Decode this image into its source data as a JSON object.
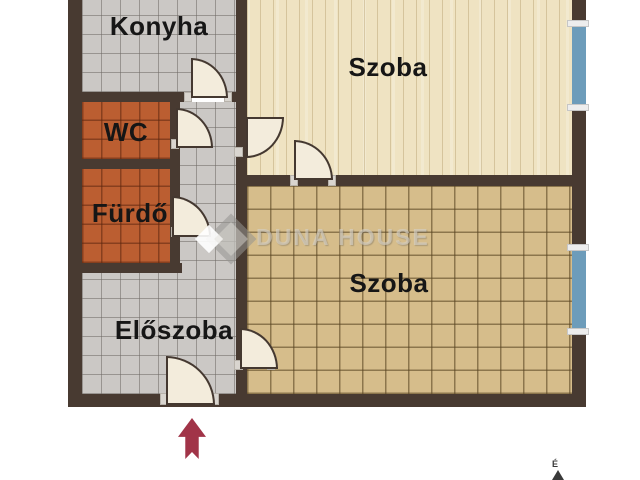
{
  "plan": {
    "rooms": [
      {
        "name": "konyha",
        "label": "Konyha"
      },
      {
        "name": "wc",
        "label": "WC"
      },
      {
        "name": "furdo",
        "label": "Fürdő"
      },
      {
        "name": "eloszoba",
        "label": "Előszoba"
      },
      {
        "name": "szoba_top",
        "label": "Szoba"
      },
      {
        "name": "szoba_bottom",
        "label": "Szoba"
      }
    ],
    "doors": [
      "konyha",
      "wc",
      "szoba-top",
      "szoba-divider",
      "furdo",
      "szoba-bottom",
      "entrance"
    ],
    "windows": [
      {
        "id": "window-1",
        "wall": "right"
      },
      {
        "id": "window-2",
        "wall": "right"
      }
    ],
    "entrance_arrow": {
      "direction": "up",
      "color": "#a13448"
    },
    "compass": {
      "label": "É"
    },
    "watermark": {
      "text": "DUNA HOUSE",
      "logo": "diamond-logo"
    },
    "colors": {
      "wall": "#483a31",
      "tile_gray": "#cbc8c5",
      "tile_terracotta": "#bb5e31",
      "tile_tan": "#d6bd8b",
      "wood": "#efe3c2",
      "window_glass": "#6d9cba",
      "arrow": "#a13448"
    }
  }
}
